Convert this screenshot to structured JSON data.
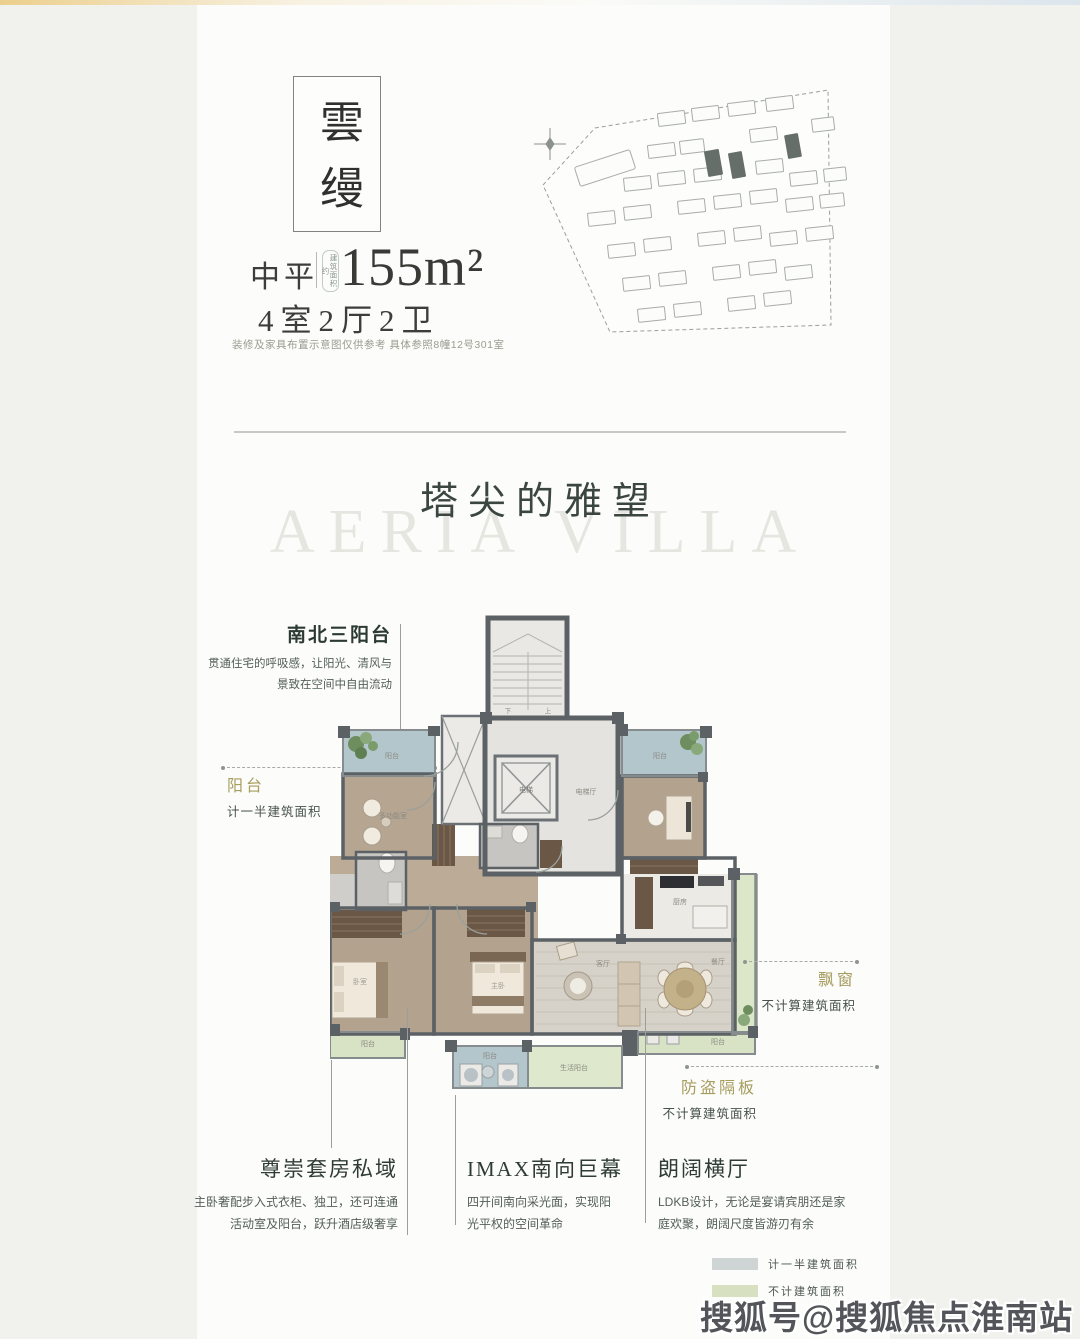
{
  "header": {
    "brand": "雲缦",
    "type_label": "中平",
    "area_stamp": "建筑面积约",
    "area_value": "155m²",
    "rooms_label": "4室2厅2卫",
    "disclaimer": "装修及家具布置示意图仅供参考 具体参照8幢12号301室"
  },
  "hero": {
    "title": "塔尖的雅望",
    "watermark": "AERIA VILLA"
  },
  "callouts": {
    "north_balcony": {
      "title": "南北三阳台",
      "lines": [
        "贯通住宅的呼吸感，让阳光、清风与",
        "景致在空间中自由流动"
      ]
    },
    "balcony": {
      "label": "阳台",
      "note": "计一半建筑面积"
    },
    "bay_window": {
      "label": "飘窗",
      "note": "不计算建筑面积"
    },
    "security_panel": {
      "label": "防盗隔板",
      "note": "不计算建筑面积"
    },
    "suite": {
      "title": "尊崇套房私域",
      "lines": [
        "主卧奢配步入式衣柜、独卫，还可连通",
        "活动室及阳台，跃升酒店级奢享"
      ]
    },
    "imax": {
      "title": "IMAX南向巨幕",
      "lines": [
        "四开间南向采光面，实现阳",
        "光平权的空间革命"
      ]
    },
    "hall": {
      "title": "朗阔横厅",
      "lines": [
        "LDKB设计，无论是宴请宾朋还是家",
        "庭欢聚，朗阔尺度皆游刃有余"
      ]
    }
  },
  "floorplan_labels": {
    "balcony": "阳台",
    "life_balcony": "生活阳台",
    "elevator": "电梯",
    "elevator_hall": "电梯厅",
    "kitchen": "厨房",
    "dining": "餐厅",
    "living": "客厅",
    "multi_room": "多功能室",
    "master": "主卧",
    "bedroom": "卧室",
    "down": "下",
    "up": "上"
  },
  "legend": {
    "items": [
      {
        "label": "计一半建筑面积",
        "color": "#ced5d4"
      },
      {
        "label": "不计建筑面积",
        "color": "#d8e0c2"
      }
    ]
  },
  "watermark_sohu": "搜狐号@搜狐焦点淮南站",
  "colors": {
    "accent_gold": "#a69d5f",
    "wall": "#5b6165",
    "balcony_blue": "#b3c6cc",
    "balcony_green": "#d8e2c4",
    "heading": "#2d3a34"
  }
}
